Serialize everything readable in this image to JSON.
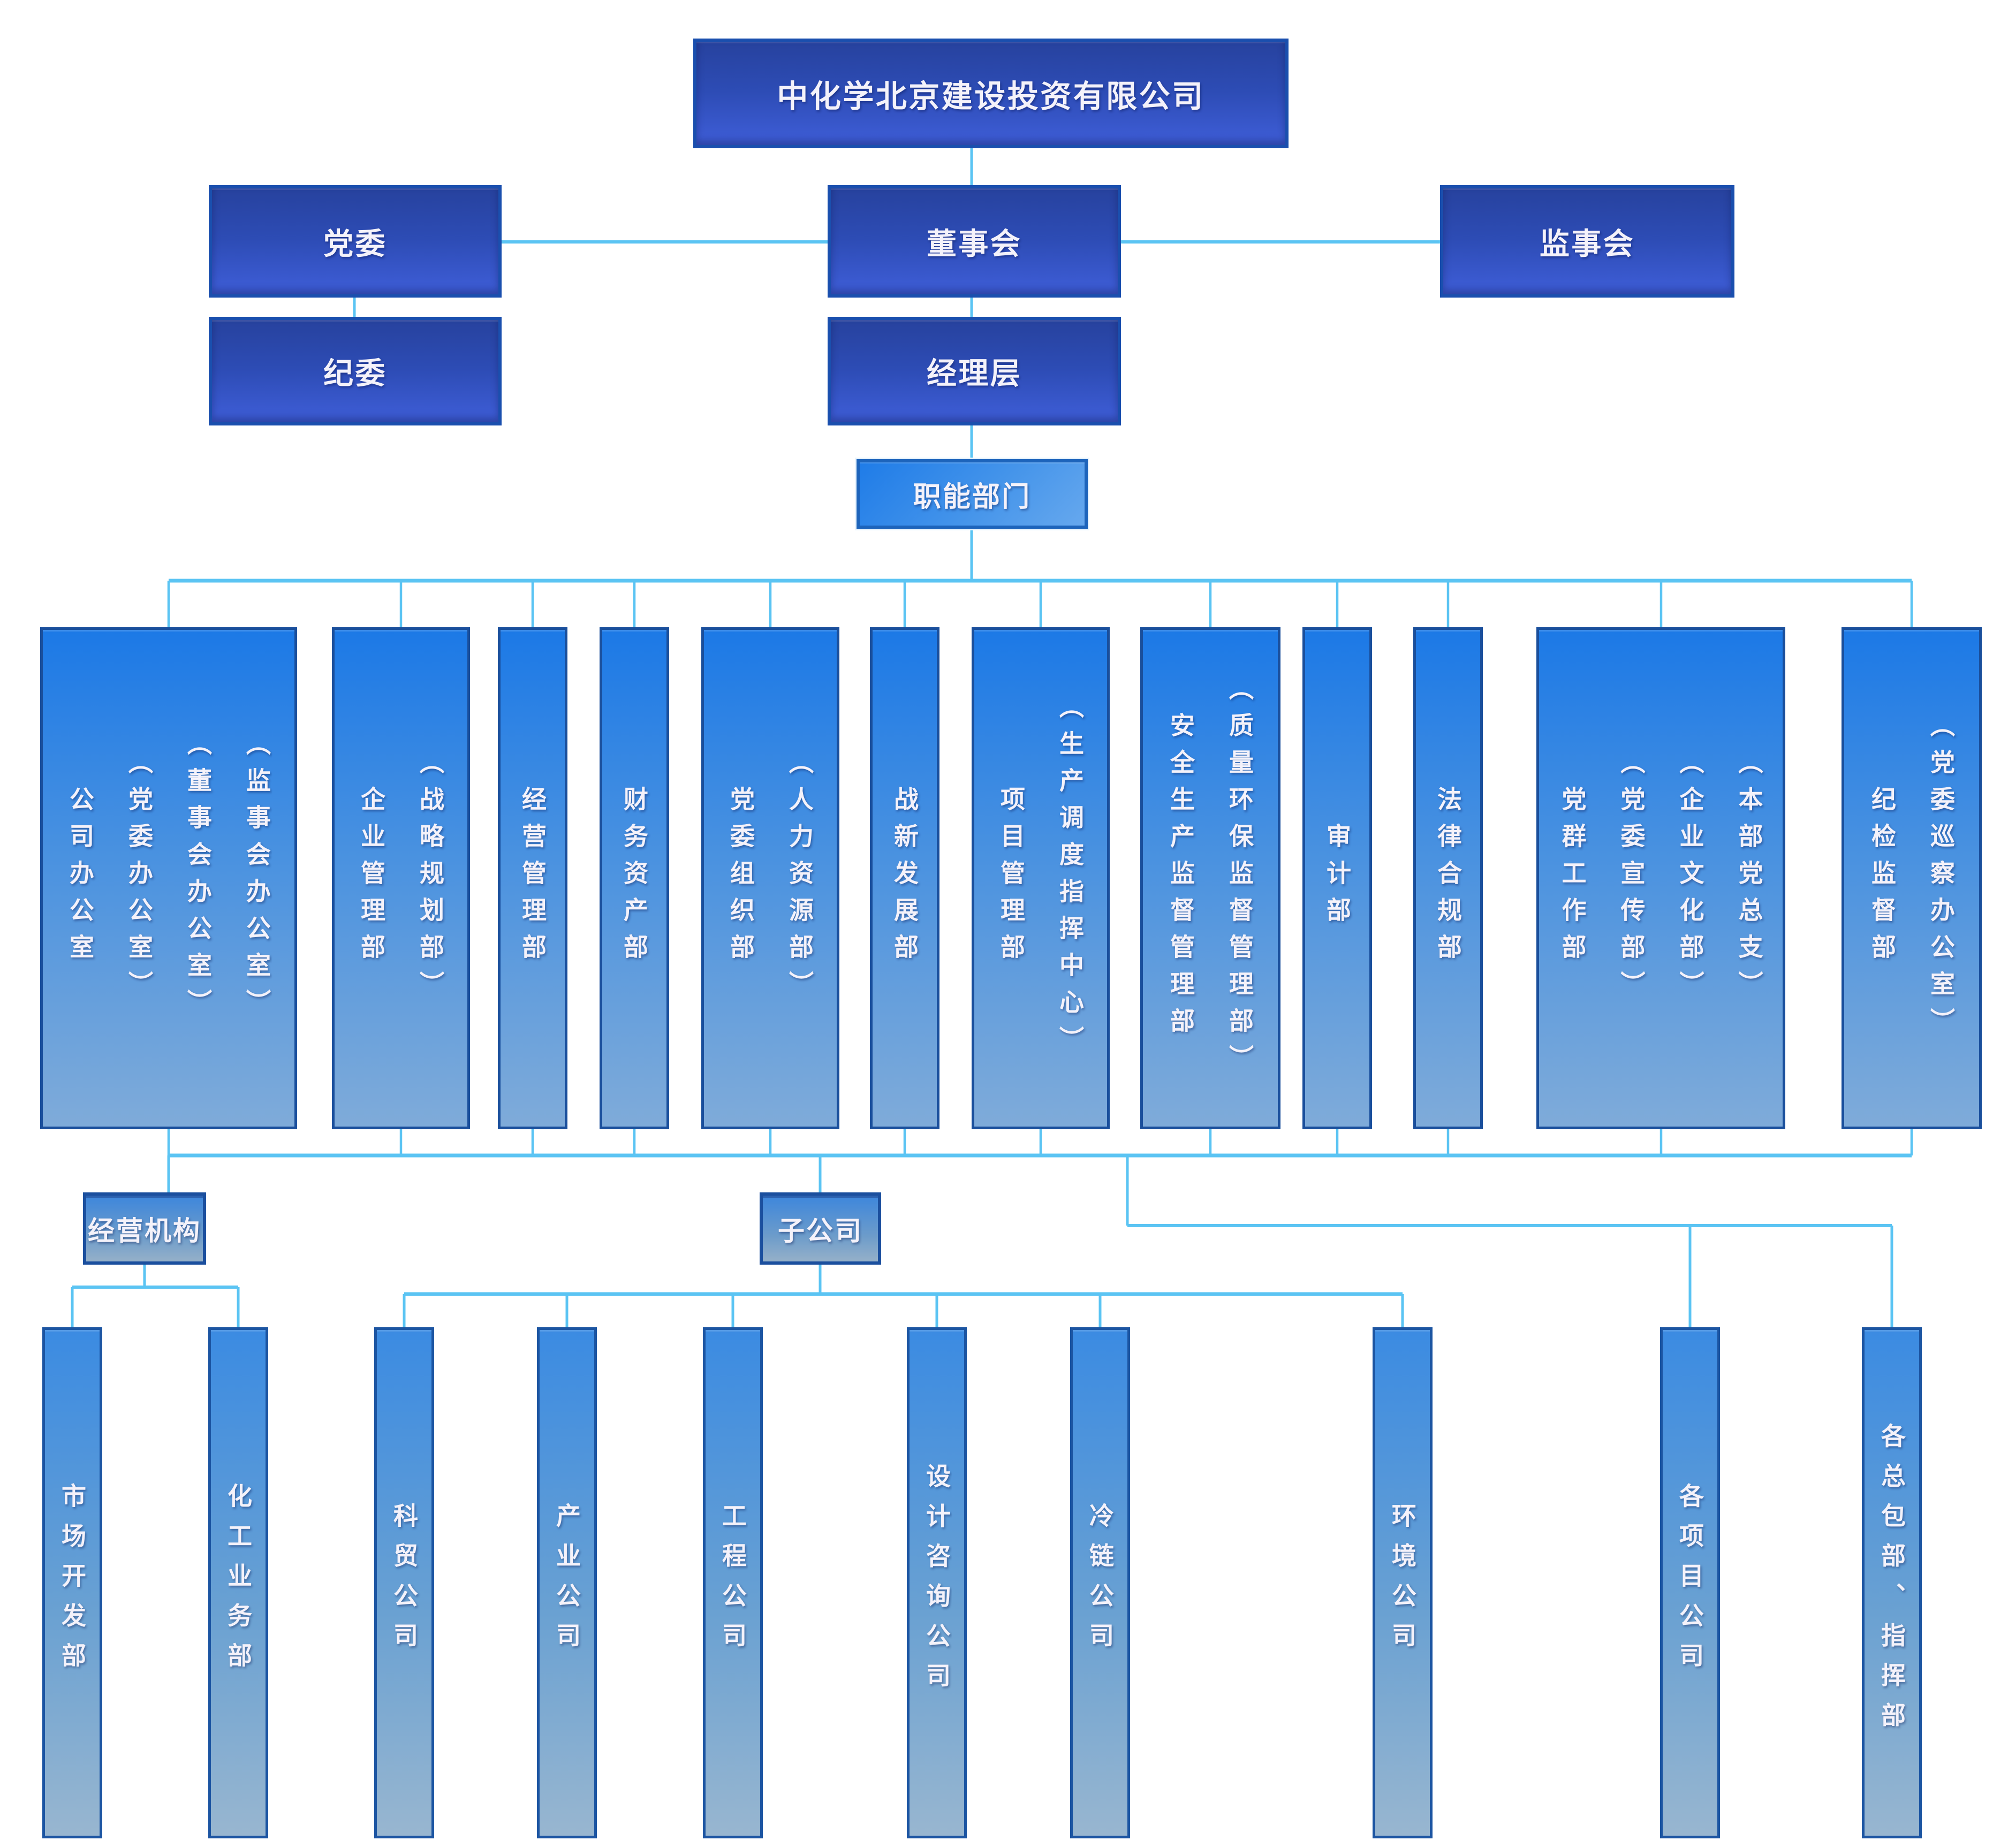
{
  "title": "中化学北京建设投资有限公司组织机构图",
  "colors": {
    "background": "#ffffff",
    "connector_line": "#5bc4f3",
    "dark_box_top": "#27429e",
    "dark_box_bottom": "#3f5ed8",
    "light_box_top": "#1c79e6",
    "light_box_bottom": "#7fabd9",
    "border_dark_navy": "#1a4f9c",
    "text": "#f4f2fa"
  },
  "root": {
    "label": "中化学北京建设投资有限公司"
  },
  "governance": {
    "party_committee": "党委",
    "board_of_directors": "董事会",
    "board_of_supervisors": "监事会",
    "discipline_committee": "纪委",
    "management_level": "经理层"
  },
  "functional": {
    "header": "职能部门",
    "departments": [
      {
        "lines": [
          "公司办公室",
          "（党委办公室）",
          "（董事会办公室）",
          "（监事会办公室）"
        ]
      },
      {
        "lines": [
          "企业管理部",
          "（战略规划部）"
        ]
      },
      {
        "lines": [
          "经营管理部"
        ]
      },
      {
        "lines": [
          "财务资产部"
        ]
      },
      {
        "lines": [
          "党委组织部",
          "（人力资源部）"
        ]
      },
      {
        "lines": [
          "战新发展部"
        ]
      },
      {
        "lines": [
          "项目管理部",
          "（生产调度指挥中心）"
        ]
      },
      {
        "lines": [
          "安全生产监督管理部",
          "（质量环保监督管理部）"
        ]
      },
      {
        "lines": [
          "审计部"
        ]
      },
      {
        "lines": [
          "法律合规部"
        ]
      },
      {
        "lines": [
          "党群工作部",
          "（党委宣传部）",
          "（企业文化部）",
          "（本部党总支）"
        ]
      },
      {
        "lines": [
          "纪检监督部",
          "（党委巡察办公室）"
        ]
      }
    ]
  },
  "business": {
    "header": "经营机构",
    "units": [
      "市场开发部",
      "化工业务部"
    ]
  },
  "subsidiaries": {
    "header": "子公司",
    "companies": [
      "科贸公司",
      "产业公司",
      "工程公司",
      "设计咨询公司",
      "冷链公司",
      "环境公司"
    ]
  },
  "project_units": {
    "companies": [
      "各项目公司",
      "各总包部、指挥部"
    ]
  }
}
